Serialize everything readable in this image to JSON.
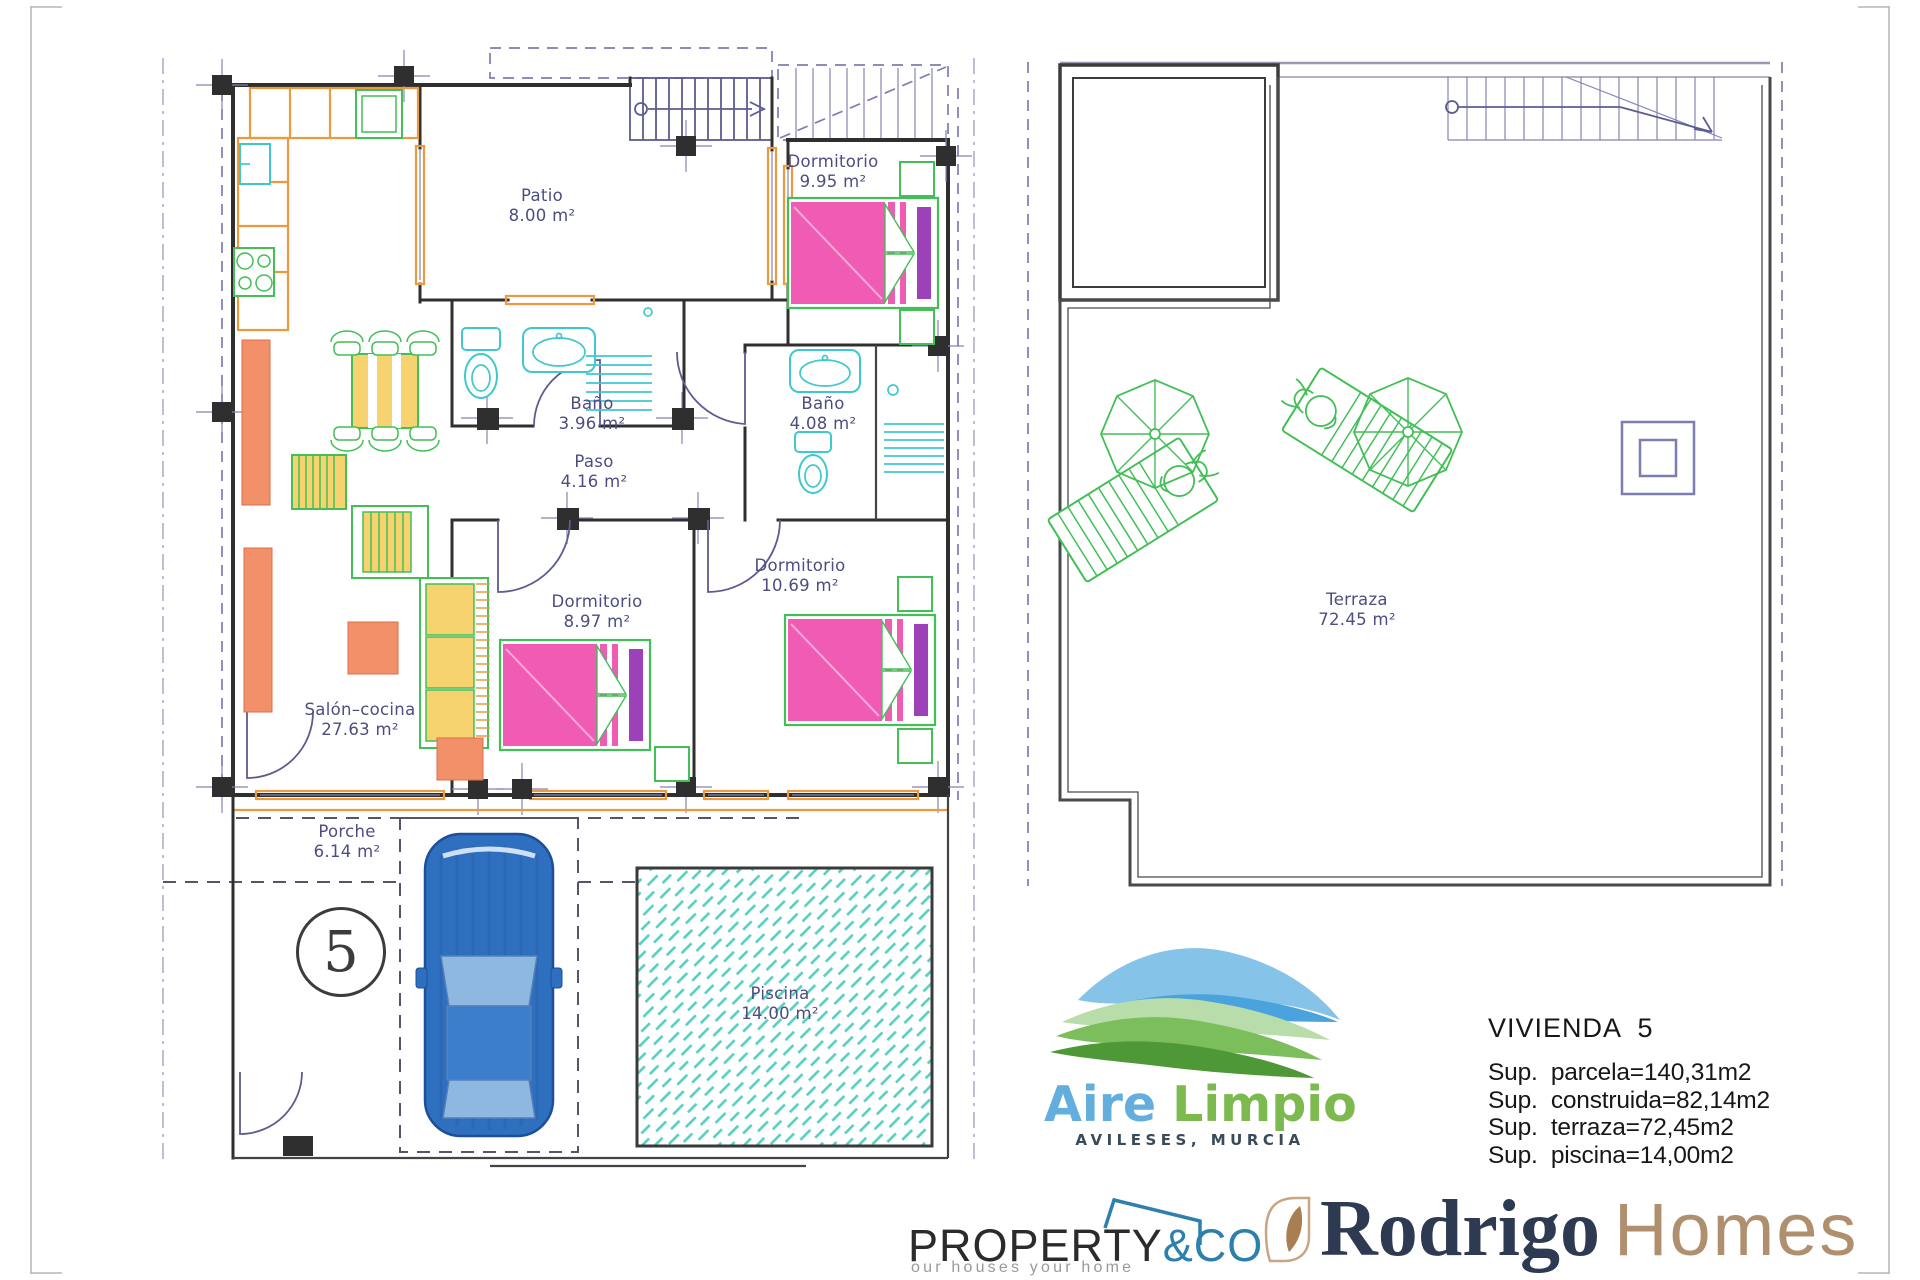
{
  "floor_plan": {
    "unit_number": "5",
    "rooms": [
      {
        "id": "patio",
        "name": "Patio",
        "area": "8.00 m²"
      },
      {
        "id": "dormitorio-1",
        "name": "Dormitorio",
        "area": "9.95 m²"
      },
      {
        "id": "bano-1",
        "name": "Baño",
        "area": "3.96 m²"
      },
      {
        "id": "bano-2",
        "name": "Baño",
        "area": "4.08 m²"
      },
      {
        "id": "paso",
        "name": "Paso",
        "area": "4.16 m²"
      },
      {
        "id": "dormitorio-2",
        "name": "Dormitorio",
        "area": "8.97 m²"
      },
      {
        "id": "dormitorio-3",
        "name": "Dormitorio",
        "area": "10.69 m²"
      },
      {
        "id": "salon-cocina",
        "name": "Salón–cocina",
        "area": "27.63 m²"
      },
      {
        "id": "porche",
        "name": "Porche",
        "area": "6.14 m²"
      },
      {
        "id": "piscina",
        "name": "Piscina",
        "area": "14.00 m²"
      }
    ]
  },
  "terrace_plan": {
    "room": {
      "name": "Terraza",
      "area": "72.45 m²"
    }
  },
  "info_panel": {
    "title": "VIVIENDA  5",
    "lines": [
      "Sup.  parcela=140,31m2",
      "Sup.  construida=82,14m2",
      "Sup.  terraza=72,45m2",
      "Sup.  piscina=14,00m2"
    ]
  },
  "branding": {
    "aire_limpio": {
      "word1": "Aire",
      "word2": "Limpio",
      "location": "AVILESES, MURCIA"
    },
    "property_co": {
      "word1": "PROPERTY",
      "word2": "&CO",
      "tagline": "our houses your home"
    },
    "rodrigo_homes": {
      "word1": "Rodrigo",
      "word2": "Homes"
    }
  },
  "colors": {
    "wall": "#2f2f2f",
    "annotation_blue": "#5c5c91",
    "label_blue": "#4d4d82",
    "orange": "#eb9a3d",
    "green": "#43bf57",
    "cyan": "#3fc8ce",
    "yellow": "#f6d36e",
    "salmon": "#f2906a",
    "pink": "#f05cb4",
    "purple": "#9d41b8",
    "car_blue": "#2f6fc0",
    "pool_teal": "#56cfc0",
    "aire_blue": "#64aede",
    "aire_green": "#7cb94e",
    "property_blue": "#2d7fae",
    "rodrigo_navy": "#2d3a52",
    "rodrigo_tan": "#b08f6e"
  }
}
